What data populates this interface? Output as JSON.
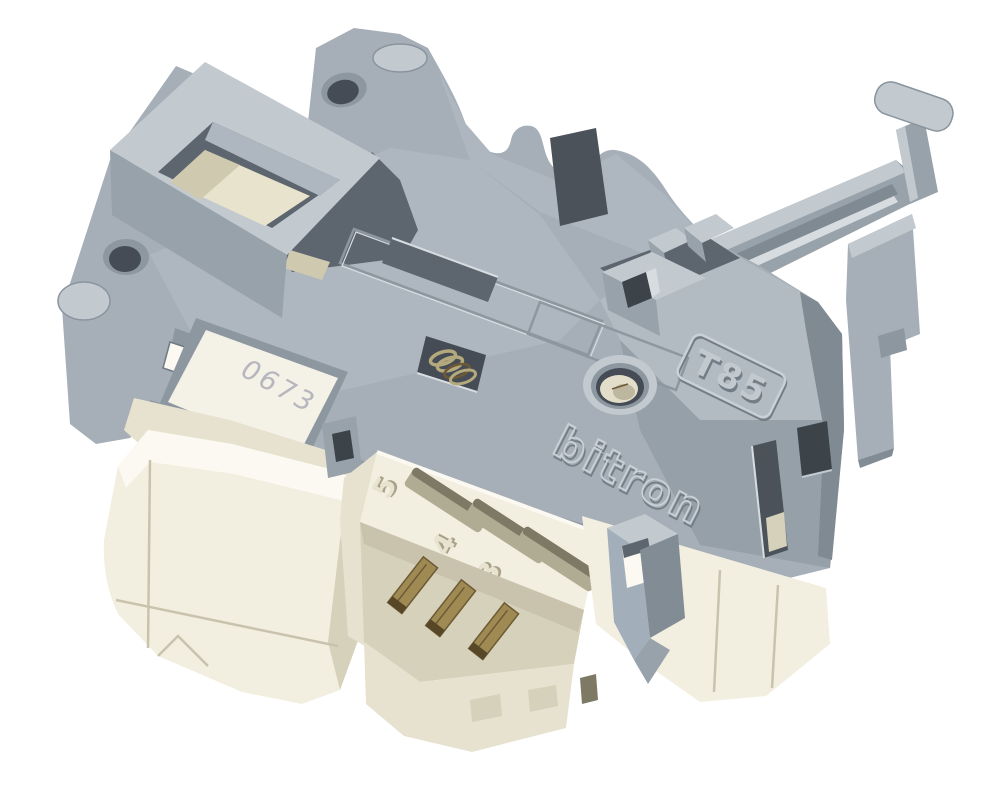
{
  "image": {
    "subject": "Washing machine door interlock switch, product photo on white background",
    "background_color": "#ffffff"
  },
  "markings": {
    "model": "T85",
    "brand_logo": "bitron",
    "label_code": "0673",
    "pin_labels": [
      "5",
      "4",
      "3"
    ]
  },
  "colors": {
    "background": "#ffffff",
    "gray_body": "#a6afb7",
    "gray_light": "#c2c9cf",
    "gray_lighter": "#d6dce0",
    "gray_mid": "#98a2ab",
    "gray_dark": "#828c95",
    "gray_deep": "#5d656e",
    "gap_dark": "#3c4349",
    "shadow_mid": "#4b5259",
    "facet_deck": "#aeb7bf",
    "facet_front": "#909aa4",
    "facet_right_hi": "#b2bac2",
    "facet_right_lo": "#96a0a9",
    "edge_strip": "#808a93",
    "hole_dark": "#454c55",
    "hole_ring": "#8d97a0",
    "cream_light": "#f2efe0",
    "cream_mid": "#e7e2cf",
    "cream_dark": "#d6d1bb",
    "cream_shadow": "#c9c3ae",
    "white_bevel": "#fbf9f1",
    "slot_fill": "#b0ab93",
    "slot_shadow": "#7d7965",
    "insert_cream": "#e3deca",
    "insert_shadow": "#bdb7a0",
    "latch_cream": "#e8e3cd",
    "latch_shadow": "#cfc9b0",
    "brass": "#a08a54",
    "brass_dark": "#6d5a35",
    "pin_tip": "#574727",
    "spring_metal": "#b3a97c",
    "label_bg": "#f4f1e7",
    "label_text": "#b6b6be",
    "emboss_light": "#c9d0d6",
    "emboss_dark": "#737d86",
    "digit_face": "#e8e3cf",
    "digit_shadow": "#a9a289",
    "clip_gray": "#a2aeb9"
  }
}
